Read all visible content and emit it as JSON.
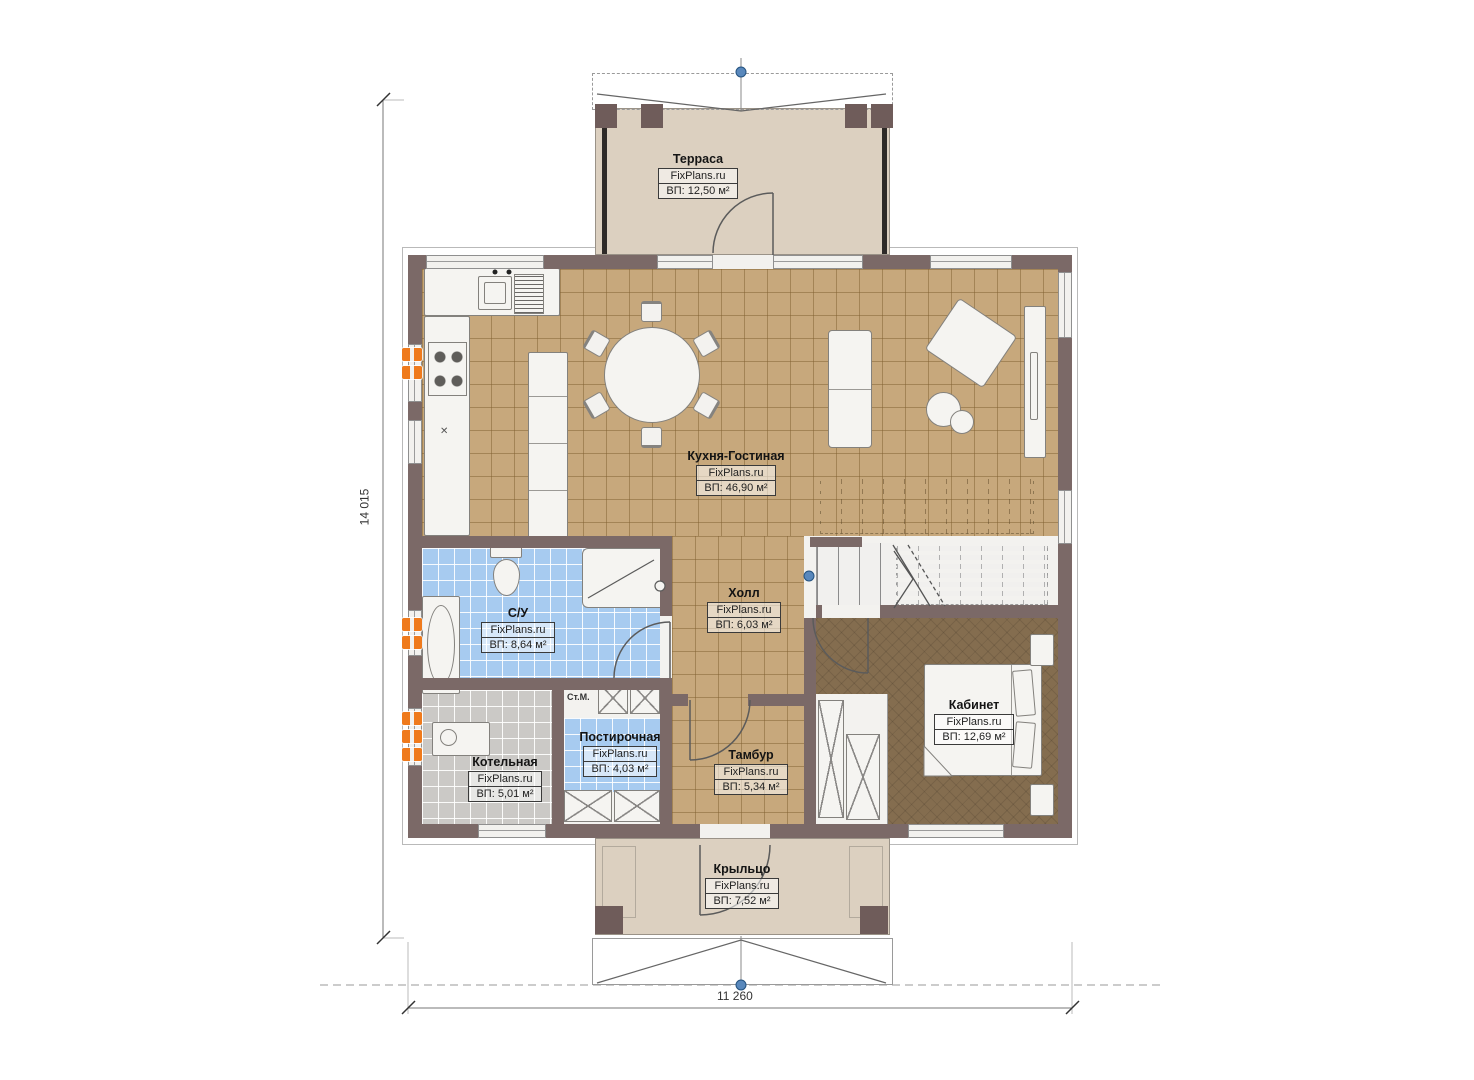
{
  "brand": "FixPlans.ru",
  "rooms": [
    {
      "id": "terrace",
      "name": "Терраса",
      "brand": "FixPlans.ru",
      "area": "ВП: 12,50 м²"
    },
    {
      "id": "kitchen",
      "name": "Кухня-Гостиная",
      "brand": "FixPlans.ru",
      "area": "ВП: 46,90 м²"
    },
    {
      "id": "hall",
      "name": "Холл",
      "brand": "FixPlans.ru",
      "area": "ВП: 6,03 м²"
    },
    {
      "id": "bathroom",
      "name": "С/У",
      "brand": "FixPlans.ru",
      "area": "ВП: 8,64 м²"
    },
    {
      "id": "laundry",
      "name": "Постирочная",
      "brand": "FixPlans.ru",
      "area": "ВП: 4,03 м²"
    },
    {
      "id": "boiler",
      "name": "Котельная",
      "brand": "FixPlans.ru",
      "area": "ВП: 5,01 м²"
    },
    {
      "id": "vestibule",
      "name": "Тамбур",
      "brand": "FixPlans.ru",
      "area": "ВП: 5,34 м²"
    },
    {
      "id": "office",
      "name": "Кабинет",
      "brand": "FixPlans.ru",
      "area": "ВП: 12,69 м²"
    },
    {
      "id": "porch",
      "name": "Крыльцо",
      "brand": "FixPlans.ru",
      "area": "ВП: 7,52 м²"
    }
  ],
  "dimensions": {
    "height_mm": "14 015",
    "width_mm": "11 260"
  },
  "annotations": {
    "washing_machine": "Ст.М.",
    "sink_cross": "✕"
  },
  "colors": {
    "wall": "#7b6967",
    "tile_tan": "#c7a87c",
    "tile_blue": "#a7cbf0",
    "tile_gray": "#cbc9c6",
    "carpet": "#846d4f",
    "deck": "#dcd0c0",
    "radiator": "#ef7a1c",
    "marker": "#5988bc"
  }
}
